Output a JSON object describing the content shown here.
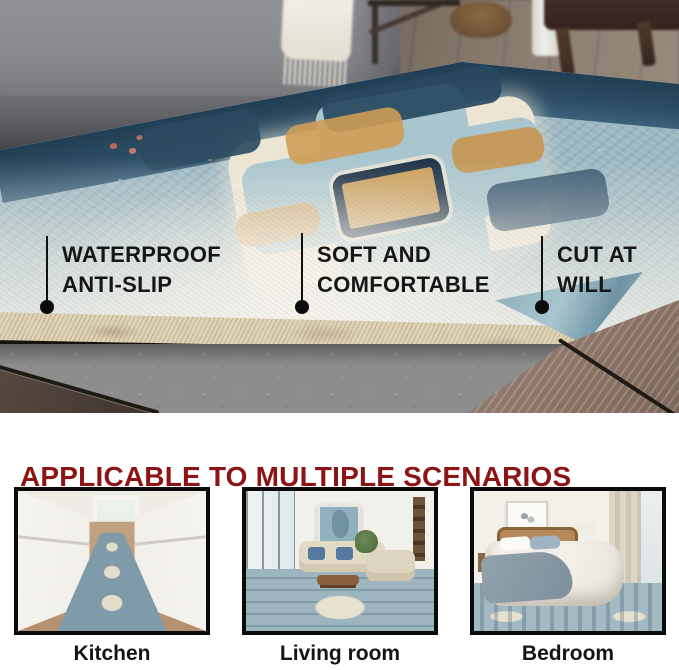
{
  "hero": {
    "callouts": [
      {
        "line1": "WATERPROOF",
        "line2": "ANTI-SLIP"
      },
      {
        "line1": "SOFT AND",
        "line2": "COMFORTABLE"
      },
      {
        "line1": "CUT AT",
        "line2": "WILL"
      }
    ],
    "scene": "folded ornate blue rug corner revealing woven backing and grey felt anti-slip pad on wood floor beside grey sofa"
  },
  "scenarios": {
    "heading": "APPLICABLE TO MULTIPLE SCENARIOS",
    "items": [
      {
        "label": "Kitchen",
        "scene": "white galley kitchen with blue runner rug"
      },
      {
        "label": "Living room",
        "scene": "bright living room with beige sofas and large blue medallion rug"
      },
      {
        "label": "Bedroom",
        "scene": "bedroom with bed on blue medallion rug"
      }
    ]
  },
  "colors": {
    "heading_red": "#8c1414",
    "callout_text": "#161616",
    "rug_navy": "#26455a",
    "rug_blue": "#9cb9c3",
    "rug_cream": "#ece5d4",
    "rug_tan": "#cf9c55",
    "felt_grey": "#8d8d8d",
    "backing_tan": "#ded2b4",
    "frame_border": "#0b0b0b",
    "background": "#ffffff"
  }
}
